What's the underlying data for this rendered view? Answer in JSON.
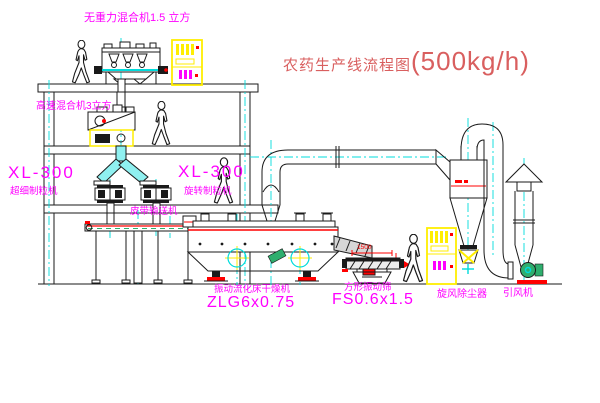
{
  "diagram": {
    "title": {
      "text": "农药生产线流程图",
      "capacity": "(500kg/h)"
    },
    "labels": {
      "gravity_mixer": "无重力混合机1.5 立方",
      "high_speed_mixer": "高速混合机3立方",
      "granulator_left_model": "XL-300",
      "granulator_left_name": "超细制粒机",
      "granulator_mid_model": "XL-300",
      "granulator_mid_name": "旋转制粒机",
      "belt_conveyor": "皮带输送机",
      "dryer_name": "振动流化床干燥机",
      "dryer_model": "ZLG6x0.75",
      "screen_name": "方形振动筛",
      "screen_model": "FS0.6x1.5",
      "cyclone": "旋风除尘器",
      "fan": "引风机"
    },
    "dimensions": {
      "screen_width": "1500"
    },
    "colors": {
      "label_magenta": "#ff00ff",
      "title_red": "#d95f5f",
      "dim_red": "#ff0000",
      "line_black": "#1a1a1a",
      "centerline_cyan": "#00dcdc",
      "highlight_yellow": "#ffee00",
      "machine_green": "#2fae6e",
      "chute_cyan": "#8ff0f0",
      "background": "#ffffff"
    }
  }
}
